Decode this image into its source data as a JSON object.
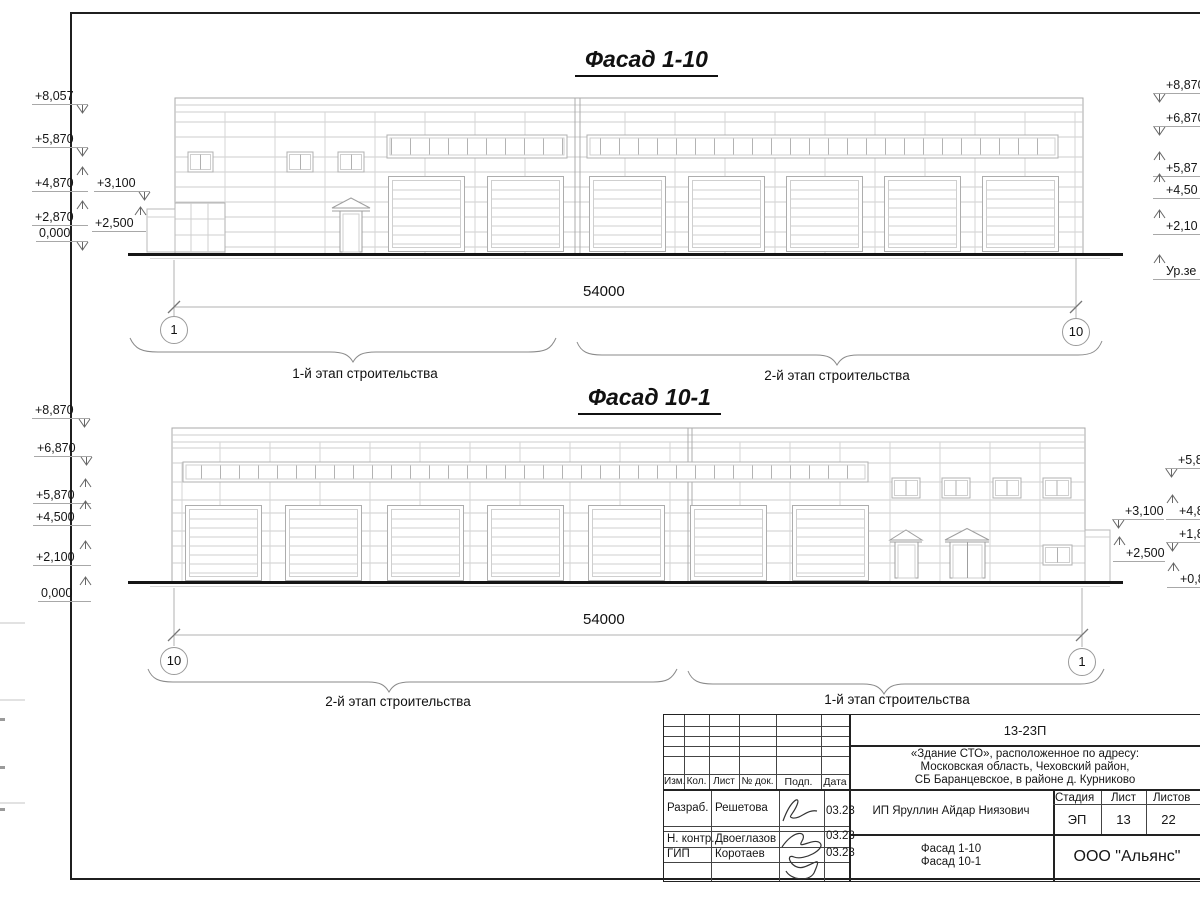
{
  "f1": {
    "title": "Фасад 1-10",
    "dim": "54000",
    "axis_left": "1",
    "axis_right": "10",
    "stage_left": "1-й этап строительства",
    "stage_right": "2-й этап строительства",
    "left_marks": [
      "+8,057",
      "+5,870",
      "+4,870",
      "+3,100",
      "+2,870",
      "0,000",
      "+2,500"
    ],
    "right_marks": [
      "+8,870",
      "+6,870",
      "+5,87",
      "+4,50",
      "+2,10",
      "Ур.зе"
    ]
  },
  "f2": {
    "title": "Фасад 10-1",
    "dim": "54000",
    "axis_left": "10",
    "axis_right": "1",
    "stage_left": "2-й этап строительства",
    "stage_right": "1-й этап строительства",
    "left_marks": [
      "+8,870",
      "+6,870",
      "+5,870",
      "+4,500",
      "+2,100",
      "0,000"
    ],
    "right_marks": [
      "+3,100",
      "+2,500",
      "+5,8",
      "+4,8",
      "+1,8",
      "+0,8"
    ]
  },
  "title_block": {
    "doc_number": "13-23П",
    "project_line1": "«Здание СТО», расположенное по адресу:",
    "project_line2": "Московская область, Чеховский район,",
    "project_line3": "СБ Баранцевское, в районе д. Курниково",
    "col_izm": "Изм.",
    "col_kol": "Кол.",
    "col_list": "Лист",
    "col_doc": "№ док.",
    "col_podp": "Подп.",
    "col_data": "Дата",
    "row1_role": "Разраб.",
    "row1_name": "Решетова",
    "row1_date": "03.23",
    "row2_role": "Н. контр.",
    "row2_name": "Двоеглазов",
    "row2_date": "03.23",
    "row3_role": "ГИП",
    "row3_name": "Коротаев",
    "row3_date": "03.23",
    "client": "ИП Яруллин Айдар Ниязович",
    "stage_label": "Стадия",
    "list_label": "Лист",
    "listov_label": "Листов",
    "stage": "ЭП",
    "sheet": "13",
    "sheets": "22",
    "drawing1": "Фасад 1-10",
    "drawing2": "Фасад 10-1",
    "company": "ООО \"Альянс\""
  }
}
